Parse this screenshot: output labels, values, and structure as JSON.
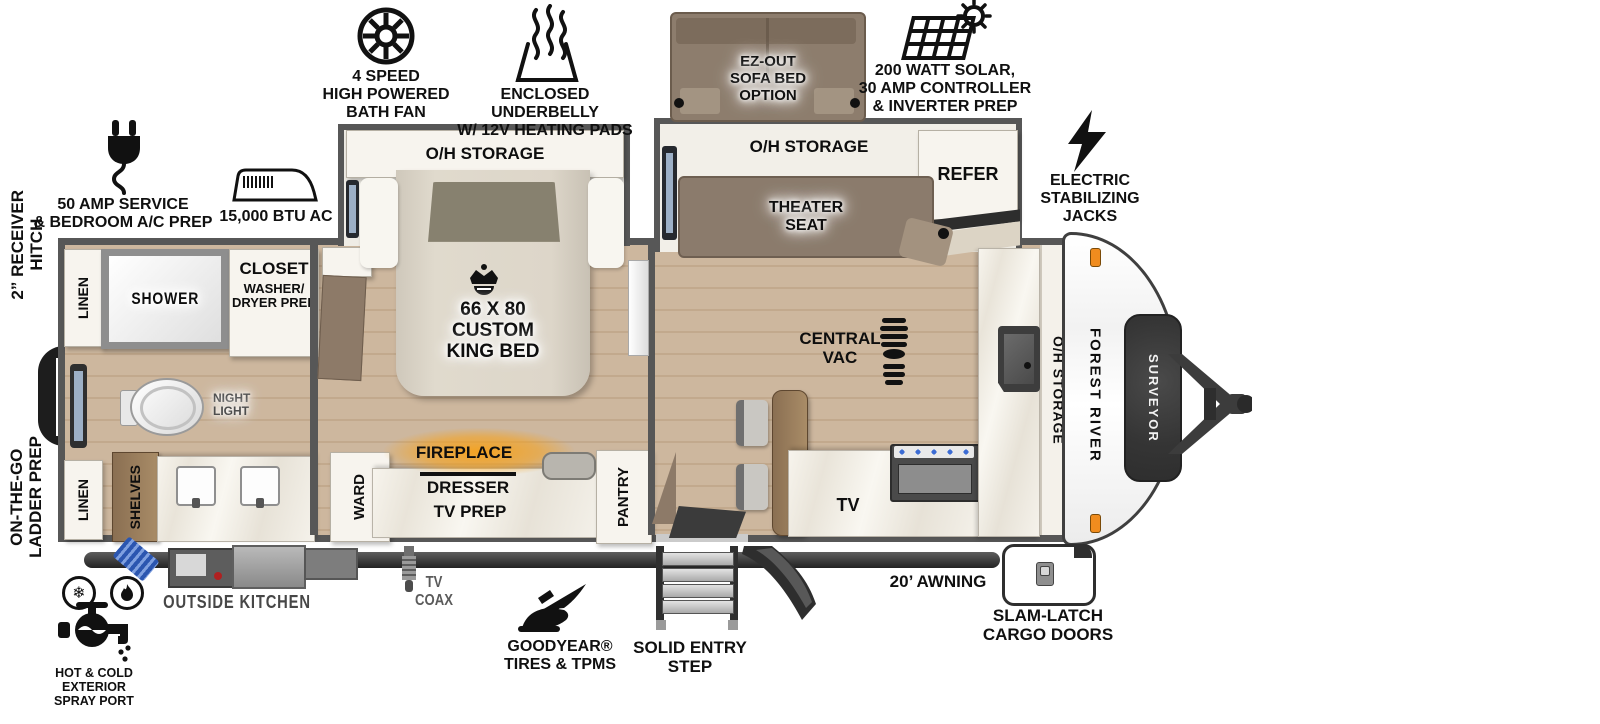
{
  "colors": {
    "wall": "#575757",
    "floor": "#cdb79e",
    "wood": "#9c8161",
    "seat_brown": "#8b7b6c",
    "fire_glow": "#f6a21c",
    "burner_blue": "#3c6cd4",
    "marker_orange": "#f08c1e"
  },
  "brand": {
    "maker": "FOREST RIVER",
    "model": "SURVEYOR"
  },
  "icons": {
    "snowflake": "❄"
  },
  "callouts": {
    "bath_fan": "4 SPEED\nHIGH POWERED\nBATH FAN",
    "underbelly": "ENCLOSED UNDERBELLY\nW/ 12V HEATING PADS",
    "sofa_bed_option": "EZ-OUT\nSOFA BED\nOPTION",
    "solar": "200 WATT SOLAR,\n30 AMP CONTROLLER\n& INVERTER PREP",
    "service_50amp": "50 AMP SERVICE\n& BEDROOM A/C PREP",
    "ac_unit": "15,000 BTU AC",
    "receiver_hitch": "2” RECEIVER\nHITCH",
    "ladder_prep": "ON-THE-GO\nLADDER PREP",
    "stabilizing_jacks": "ELECTRIC\nSTABILIZING\nJACKS",
    "spray_port": "HOT & COLD EXTERIOR\nSPRAY PORT",
    "outside_kitchen": "OUTSIDE KITCHEN",
    "tv_coax": "TV\nCOAX",
    "goodyear_brand": "GOODYEAR®",
    "goodyear_sub": "TIRES & TPMS",
    "entry_step": "SOLID ENTRY\nSTEP",
    "awning": "20’ AWNING",
    "cargo_doors": "SLAM-LATCH\nCARGO DOORS"
  },
  "rooms": {
    "linen_top": "LINEN",
    "shower": "SHOWER",
    "closet_title": "CLOSET",
    "closet_sub": "WASHER/\nDRYER PREP",
    "night_light": "NIGHT\nLIGHT",
    "linen_bottom": "LINEN",
    "shelves": "SHELVES",
    "oh_storage_bedroom": "O/H STORAGE",
    "king_bed": "66 X 80\nCUSTOM\nKING BED",
    "ward": "WARD",
    "fireplace": "FIREPLACE",
    "dresser": "DRESSER",
    "tv_prep": "TV PREP",
    "pantry": "PANTRY",
    "oh_storage_living": "O/H STORAGE",
    "theater_seat": "THEATER\nSEAT",
    "refer": "REFER",
    "central_vac": "CENTRAL\nVAC",
    "tv": "TV",
    "oh_storage_kitchen": "O/H STORAGE"
  }
}
